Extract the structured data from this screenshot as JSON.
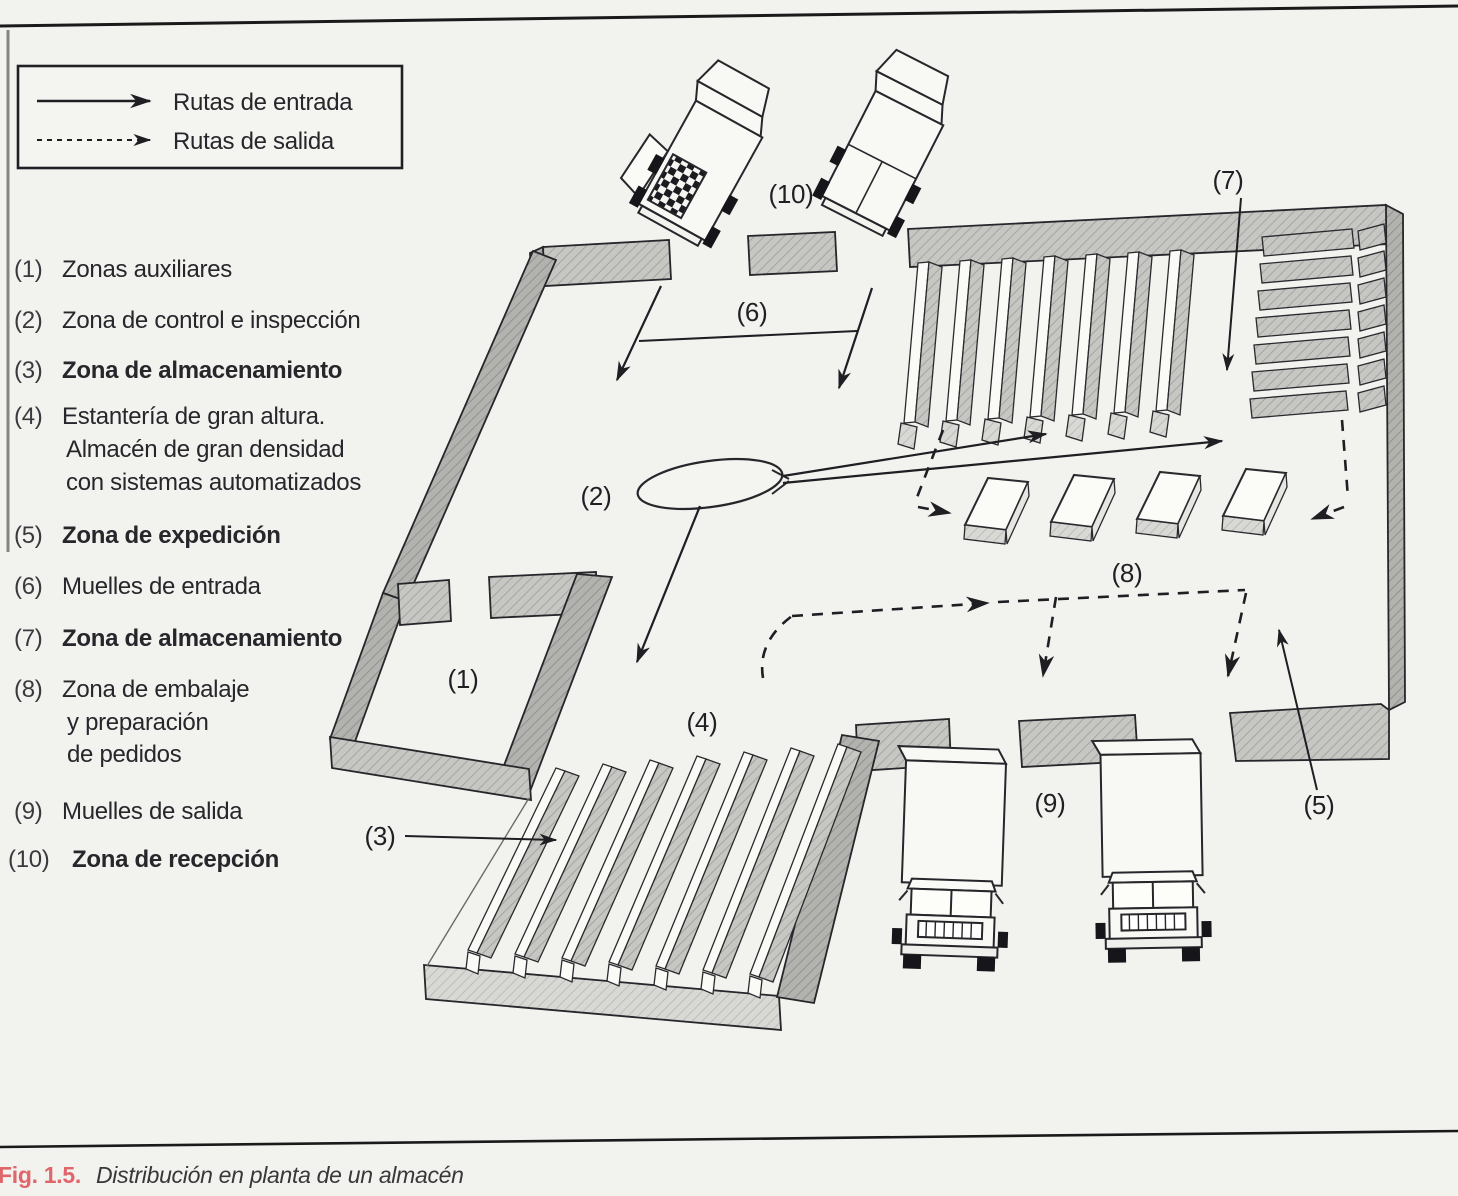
{
  "legend": {
    "entrada": "Rutas de entrada",
    "salida": "Rutas de salida"
  },
  "zones": {
    "items": [
      {
        "num": "(1)",
        "lines": [
          "Zonas auxiliares"
        ],
        "bold": false
      },
      {
        "num": "(2)",
        "lines": [
          "Zona de control e inspección"
        ],
        "bold": false
      },
      {
        "num": "(3)",
        "lines": [
          "Zona de almacenamiento"
        ],
        "bold": true
      },
      {
        "num": "(4)",
        "lines": [
          "Estantería de gran altura.",
          "Almacén de gran densidad",
          "con sistemas automatizados"
        ],
        "bold": false
      },
      {
        "num": "(5)",
        "lines": [
          "Zona de expedición"
        ],
        "bold": true
      },
      {
        "num": "(6)",
        "lines": [
          "Muelles de entrada"
        ],
        "bold": false
      },
      {
        "num": "(7)",
        "lines": [
          "Zona de almacenamiento"
        ],
        "bold": true
      },
      {
        "num": "(8)",
        "lines": [
          "Zona de embalaje",
          "y preparación",
          "de pedidos"
        ],
        "bold": false
      },
      {
        "num": "(9)",
        "lines": [
          "Muelles de salida"
        ],
        "bold": false
      },
      {
        "num": "(10)",
        "lines": [
          "Zona de recepción"
        ],
        "bold": true
      }
    ]
  },
  "diagram_labels": {
    "l1": "(1)",
    "l2": "(2)",
    "l3": "(3)",
    "l4": "(4)",
    "l5": "(5)",
    "l6": "(6)",
    "l7": "(7)",
    "l8": "(8)",
    "l9": "(9)",
    "l10": "(10)"
  },
  "caption": {
    "fig": "Fig. 1.5.",
    "title": "Distribución en planta de un almacén"
  },
  "colors": {
    "paper": "#f2f3ef",
    "ink": "#26262b",
    "wall_gray": "#c6c7c3",
    "caption_red": "#e0666b"
  }
}
